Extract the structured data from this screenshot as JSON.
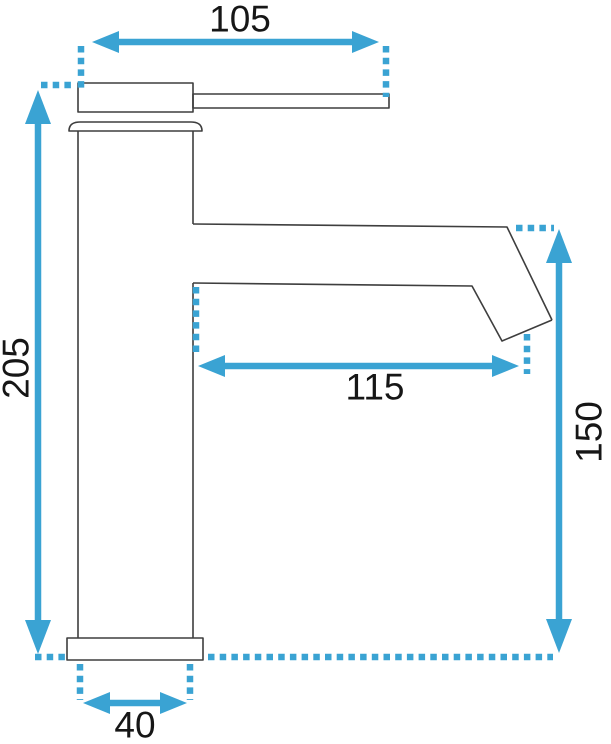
{
  "diagram": {
    "dimensions": {
      "top_width": {
        "label": "105"
      },
      "total_height": {
        "label": "205"
      },
      "spout_reach": {
        "label": "115"
      },
      "spout_height": {
        "label": "150"
      },
      "base_width": {
        "label": "40"
      }
    }
  },
  "colors": {
    "accent": "#3aa3d3",
    "outline": "#3e3e3e",
    "label": "#161616",
    "background": "#ffffff"
  }
}
